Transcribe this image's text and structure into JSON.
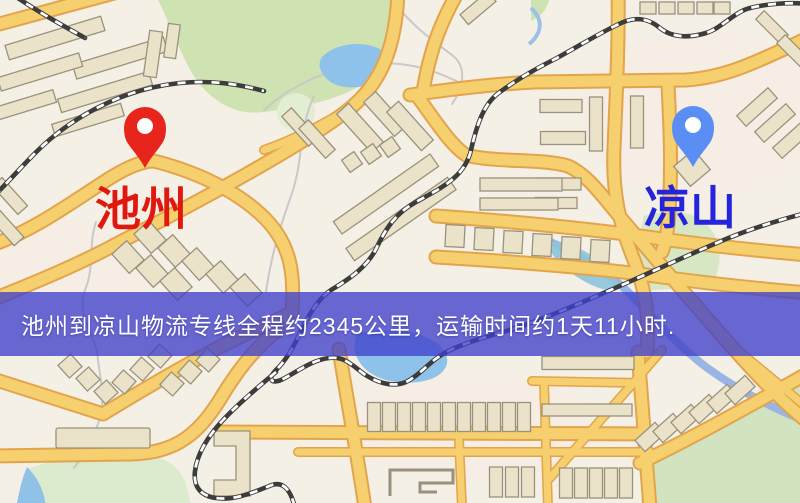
{
  "map": {
    "origin": {
      "label": "池州",
      "marker": "red-pin",
      "marker_color": "#e8251c",
      "label_color": "#e0180f"
    },
    "destination": {
      "label": "凉山",
      "marker": "blue-pin",
      "marker_color": "#5b8ef4",
      "label_color": "#2524dd"
    },
    "banner": {
      "text": "池州到凉山物流专线全程约2345公里，运输时间约1天11小时.",
      "background_color": "#4040ca",
      "text_color": "#ffffff"
    },
    "route": {
      "distance": "约2345公里",
      "duration": "约1天11小时"
    },
    "palette": {
      "land": "#f4f0e6",
      "park": "#cfe2b2",
      "water": "#8ec2ea",
      "road_fill": "#f6cf6e",
      "road_casing": "#e2a44c",
      "railway": "#3c3c3c",
      "building": "#ebe2ca"
    }
  }
}
